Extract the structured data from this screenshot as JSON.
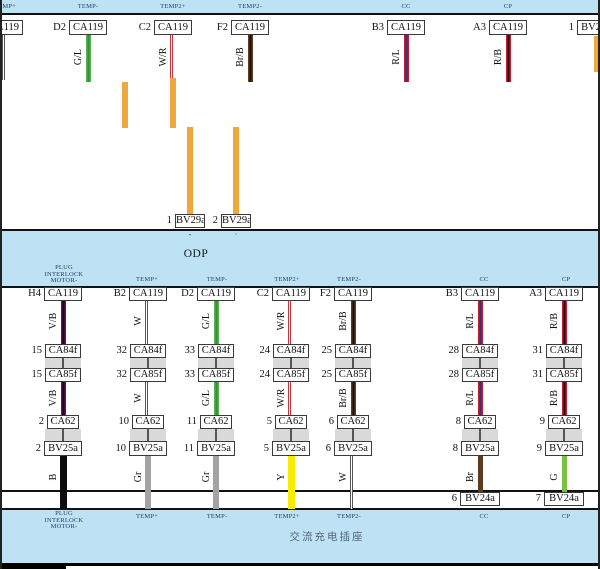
{
  "colors": {
    "band_fill": "#bde2f4",
    "band_border": "#111111",
    "label_navy": "#24436b",
    "box_border": "#3a3a3a",
    "joint_fill": "#d9d9d9",
    "joint_line": "#555555",
    "orange_jumper": "#f0a83c"
  },
  "wire_colors": {
    "V/B": {
      "main": "#6d1060",
      "stripe": "#15050f",
      "w": 5
    },
    "W": {
      "main": "#ffffff",
      "border": "#555555",
      "w": 6
    },
    "G/L": {
      "main": "#58b14c",
      "stripe": "#2f8f3a",
      "w": 5
    },
    "W/R": {
      "main": "#ffffff",
      "border": "#c43a44",
      "w": 6
    },
    "Br/B": {
      "main": "#5d3b20",
      "stripe": "#1c1007",
      "w": 5
    },
    "R/L": {
      "main": "#c81a2e",
      "stripe": "#32327a",
      "w": 5
    },
    "R/B": {
      "main": "#c81a2e",
      "stripe": "#141414",
      "w": 5
    },
    "B": {
      "main": "#0d0d0d",
      "w": 7
    },
    "Gr": {
      "main": "#a3a3a3",
      "w": 6
    },
    "Y": {
      "main": "#f6ed00",
      "w": 7
    },
    "G": {
      "main": "#7ac143",
      "w": 5
    },
    "Br": {
      "main": "#5d3b20",
      "w": 5
    },
    "Or": {
      "main": "#f0a83c",
      "w": 6
    }
  },
  "top_columns": [
    {
      "x": 5,
      "conn": "CA119",
      "box_left": -15,
      "wire": "W",
      "band_label": "TEMP+",
      "y2": 80
    },
    {
      "x": 88,
      "pin": "D2",
      "conn": "CA119",
      "wire": "G/L",
      "code": "G/L",
      "band_label": "TEMP-"
    },
    {
      "x": 173,
      "pin": "C2",
      "conn": "CA119",
      "wire": "W/R",
      "code": "W/R",
      "band_label": "TEMP2+",
      "y2": 78
    },
    {
      "x": 250,
      "pin": "F2",
      "conn": "CA119",
      "wire": "Br/B",
      "code": "Br/B",
      "band_label": "TEMP2-"
    },
    {
      "x": 406,
      "pin": "B3",
      "conn": "CA119",
      "wire": "R/L",
      "code": "R/L",
      "band_label": "CC"
    },
    {
      "x": 508,
      "pin": "A3",
      "conn": "CA119",
      "wire": "R/B",
      "code": "R/B",
      "band_label": "CP"
    },
    {
      "x": 597,
      "pin": "1",
      "conn": "BV29a",
      "box_left": 577,
      "wire": "Or",
      "y1": 36,
      "y2": 72
    }
  ],
  "orange_segments": [
    {
      "x": 125,
      "y1": 82,
      "y2": 128
    },
    {
      "x": 173,
      "y1": 78,
      "y2": 128
    },
    {
      "x": 190,
      "y1": 127,
      "y2": 214
    },
    {
      "x": 236,
      "y1": 127,
      "y2": 214
    }
  ],
  "bv29a_row": {
    "conn": "BV29a",
    "y": 214,
    "items": [
      {
        "pin": "1",
        "cx": 190
      },
      {
        "pin": "2",
        "cx": 236
      }
    ],
    "ticks": [
      {
        "x": 190,
        "t": "-"
      },
      {
        "x": 236,
        "t": "·"
      }
    ]
  },
  "odp_band": {
    "title": "ODP",
    "title_x": 196,
    "title_y": 248
  },
  "column_labels": [
    {
      "x": 64,
      "lines": [
        "PLUG",
        "INTERLOCK",
        "MOTOR-"
      ]
    },
    {
      "x": 147,
      "lines": [
        "TEMP+"
      ]
    },
    {
      "x": 217,
      "lines": [
        "TEMP-"
      ]
    },
    {
      "x": 287,
      "lines": [
        "TEMP2+"
      ]
    },
    {
      "x": 349,
      "lines": [
        "TEMP2-"
      ]
    },
    {
      "x": 484,
      "lines": [
        "CC"
      ]
    },
    {
      "x": 566,
      "lines": [
        "CP"
      ]
    }
  ],
  "middle": {
    "rows": {
      "ca119_y": 287,
      "ca84f_y": 344,
      "joint1": [
        358,
        368
      ],
      "ca85f_y": 368,
      "ca62_y": 415,
      "joint2": [
        429,
        441
      ],
      "bv25a_y": 441,
      "wire3_y2": 509,
      "wire3_y2_short": 492,
      "bv24a_y": 492,
      "code1_yc": 321,
      "code2_yc": 398,
      "code3_yc": 477
    },
    "conns": {
      "r1": "CA119",
      "r2": "CA84f",
      "r3": "CA85f",
      "r4": "CA62",
      "r5": "BV25a",
      "r6": "BV24a"
    },
    "columns": [
      {
        "x": 63,
        "top_pin": "H4",
        "wire": "V/B",
        "p_mid": "15",
        "p_low": "2",
        "bottom_wire": "B"
      },
      {
        "x": 148,
        "top_pin": "B2",
        "wire": "W",
        "p_mid": "32",
        "p_low": "10",
        "bottom_wire": "Gr"
      },
      {
        "x": 216,
        "top_pin": "D2",
        "wire": "G/L",
        "p_mid": "33",
        "p_low": "11",
        "bottom_wire": "Gr"
      },
      {
        "x": 291,
        "top_pin": "C2",
        "wire": "W/R",
        "p_mid": "24",
        "p_low": "5",
        "bottom_wire": "Y"
      },
      {
        "x": 353,
        "top_pin": "F2",
        "wire": "Br/B",
        "p_mid": "25",
        "p_low": "6",
        "bottom_wire": "W"
      },
      {
        "x": 480,
        "top_pin": "B3",
        "wire": "R/L",
        "p_mid": "28",
        "p_low": "8",
        "bottom_wire": "Br",
        "bv24a_pin": "6"
      },
      {
        "x": 564,
        "top_pin": "A3",
        "wire": "R/B",
        "p_mid": "31",
        "p_low": "9",
        "bottom_wire": "G",
        "bv24a_pin": "7"
      }
    ]
  },
  "bottom_band": {
    "component_name": "交流充电插座",
    "name_x": 327,
    "name_y": 529
  }
}
